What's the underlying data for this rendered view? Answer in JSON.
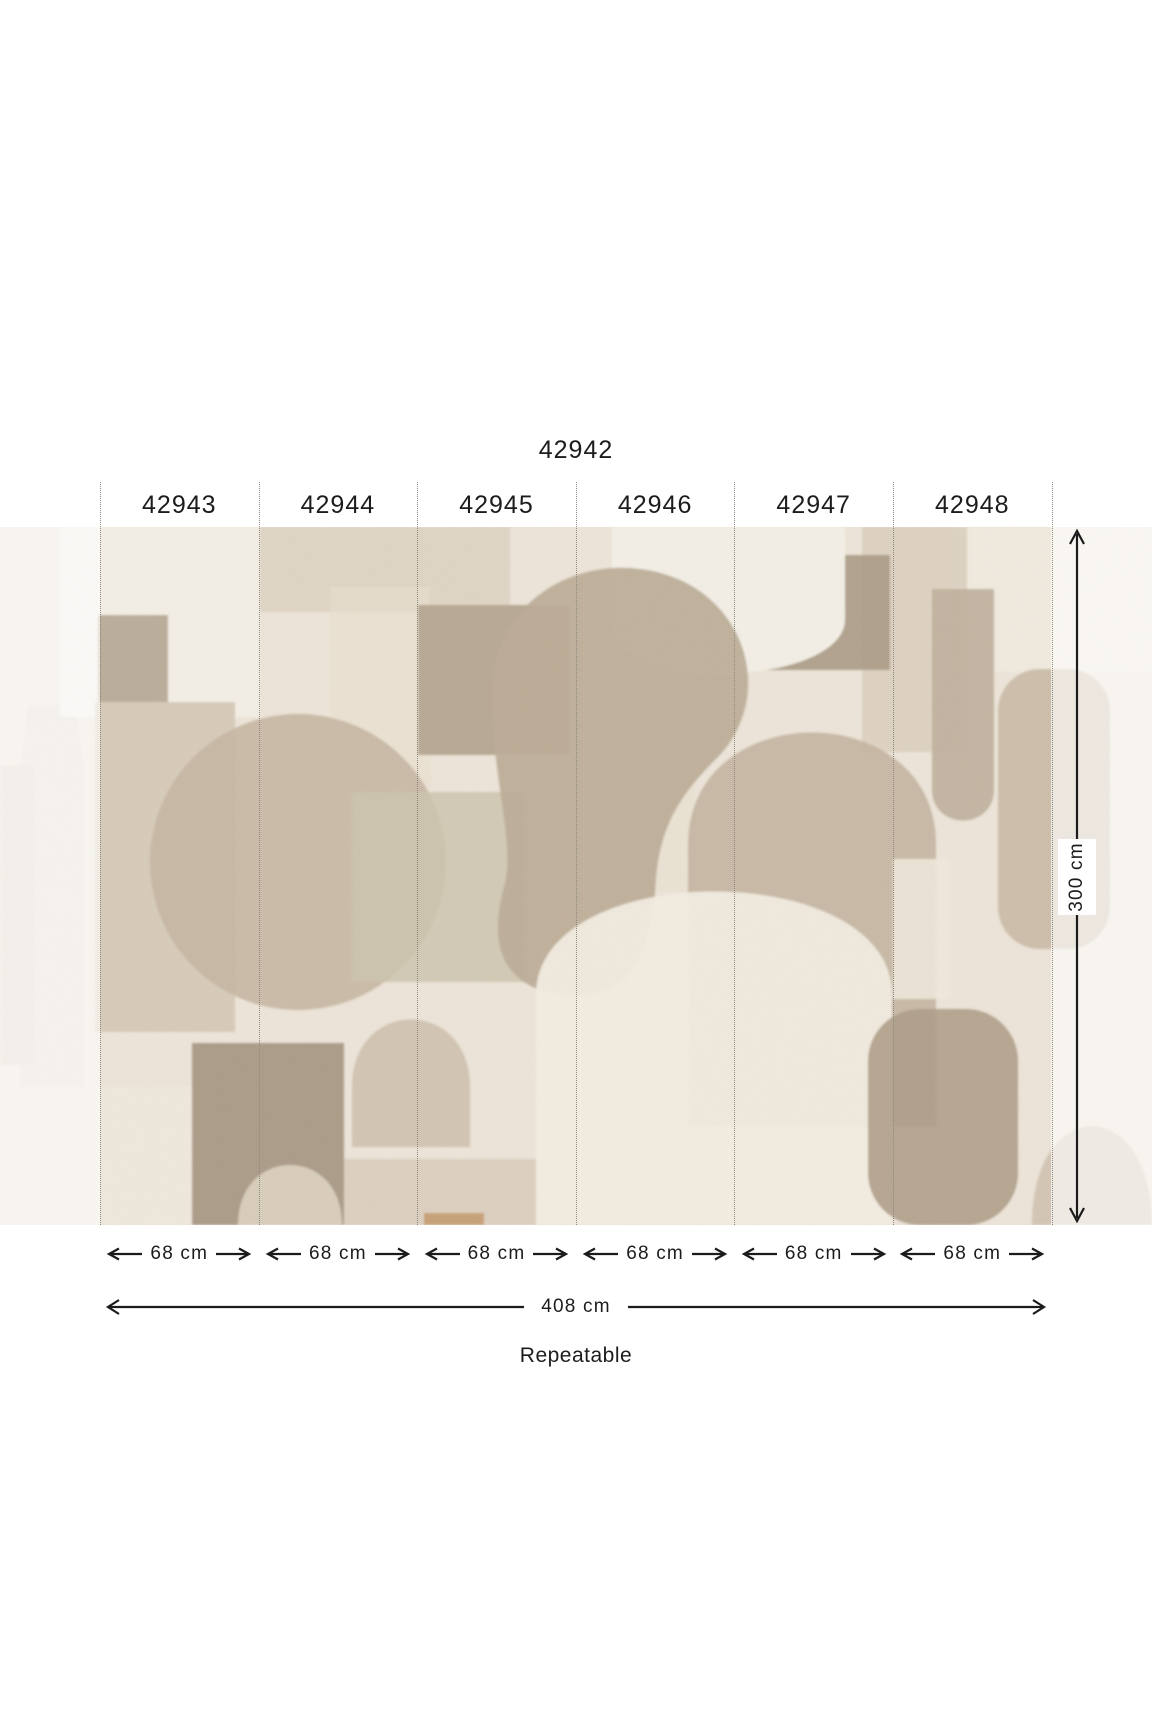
{
  "product": {
    "code": "42942"
  },
  "panels": [
    {
      "code": "42943",
      "width_label": "68 cm"
    },
    {
      "code": "42944",
      "width_label": "68 cm"
    },
    {
      "code": "42945",
      "width_label": "68 cm"
    },
    {
      "code": "42946",
      "width_label": "68 cm"
    },
    {
      "code": "42947",
      "width_label": "68 cm"
    },
    {
      "code": "42948",
      "width_label": "68 cm"
    }
  ],
  "dimensions": {
    "total_width": "408 cm",
    "height": "300 cm",
    "repeat_note": "Repeatable"
  },
  "colors": {
    "text": "#1c1c1c",
    "arrow": "#1b1b1b",
    "dotted_line": "#8d8a80",
    "page_background": "#ffffff",
    "fade_overlay": "#ffffff",
    "mural": {
      "base": "#EDE5D9",
      "cream": "#F3EFE6",
      "cream_soft": "#EFE8DC",
      "cream_block": "#EAE2D3",
      "cream_top": "#F0EADF",
      "cream_dome": "#F2EDE2",
      "sand": "#DBCFBD",
      "sand_light": "#EADFCE",
      "beige": "#D7CBB9",
      "beige_light": "#D9CDBB",
      "taupe": "#C6B7A3",
      "taupe_col": "#CDBFAB",
      "taupe_dome": "#C4B5A1",
      "taupe_pillar": "#BFB09C",
      "taupe_curve": "#C8B9A5",
      "taupe_small": "#CBBDA9",
      "deep_taupe": "#BCAC97",
      "brown_gray": "#B8A994",
      "brown_rect": "#B5A692",
      "dark_taupe": "#AC9D89",
      "dark_block": "#AB9B86",
      "dark_round": "#AF9F8A",
      "olive": "#CEC5AF",
      "warm_tan": "#C49A6B",
      "pale_bottle": "#E3DACD",
      "pale_col": "#DFD5C8",
      "pale_slot": "#EFE8DA"
    }
  }
}
